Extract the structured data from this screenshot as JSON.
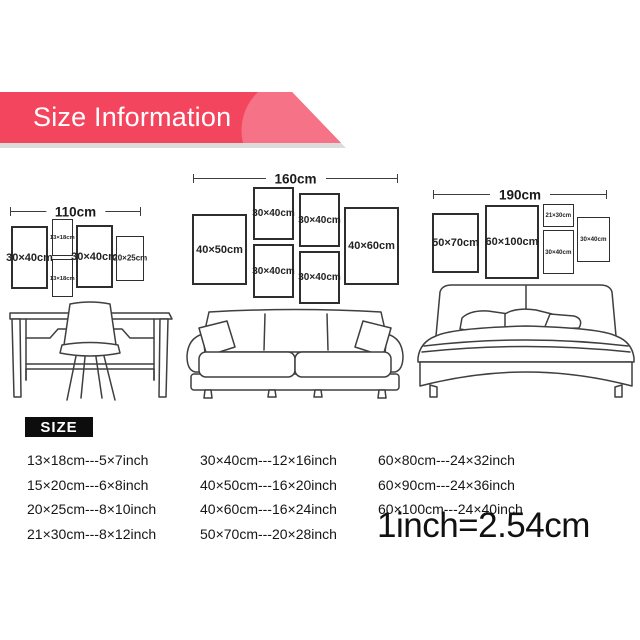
{
  "banner": {
    "title": "Size Information",
    "bg_color": "#f4455e",
    "swoosh_color": "#f57287",
    "shadow_color": "#dcdcdc"
  },
  "diagrams": [
    {
      "scene": "desk",
      "width_label": "110cm",
      "frames": [
        {
          "label": "30×40cm"
        },
        {
          "label": "13×18cm"
        },
        {
          "label": "13×18cm"
        },
        {
          "label": "30×40cm"
        },
        {
          "label": "20×25cm"
        }
      ]
    },
    {
      "scene": "sofa",
      "width_label": "160cm",
      "frames": [
        {
          "label": "40×50cm"
        },
        {
          "label": "30×40cm"
        },
        {
          "label": "30×40cm"
        },
        {
          "label": "30×40cm"
        },
        {
          "label": "30×40cm"
        },
        {
          "label": "40×60cm"
        }
      ]
    },
    {
      "scene": "bed",
      "width_label": "190cm",
      "frames": [
        {
          "label": "50×70cm"
        },
        {
          "label": "60×100cm"
        },
        {
          "label": "21×30cm"
        },
        {
          "label": "30×40cm"
        },
        {
          "label": "30×40cm"
        }
      ]
    }
  ],
  "size_list": {
    "badge": "SIZE",
    "columns": [
      [
        "13×18cm---5×7inch",
        "15×20cm---6×8inch",
        "20×25cm---8×10inch",
        "21×30cm---8×12inch"
      ],
      [
        "30×40cm---12×16inch",
        "40×50cm---16×20inch",
        "40×60cm---16×24inch",
        "50×70cm---20×28inch"
      ],
      [
        "60×80cm---24×32inch",
        "60×90cm---24×36inch",
        "60×100cm---24×40inch"
      ]
    ],
    "conversion": "1inch=2.54cm"
  }
}
